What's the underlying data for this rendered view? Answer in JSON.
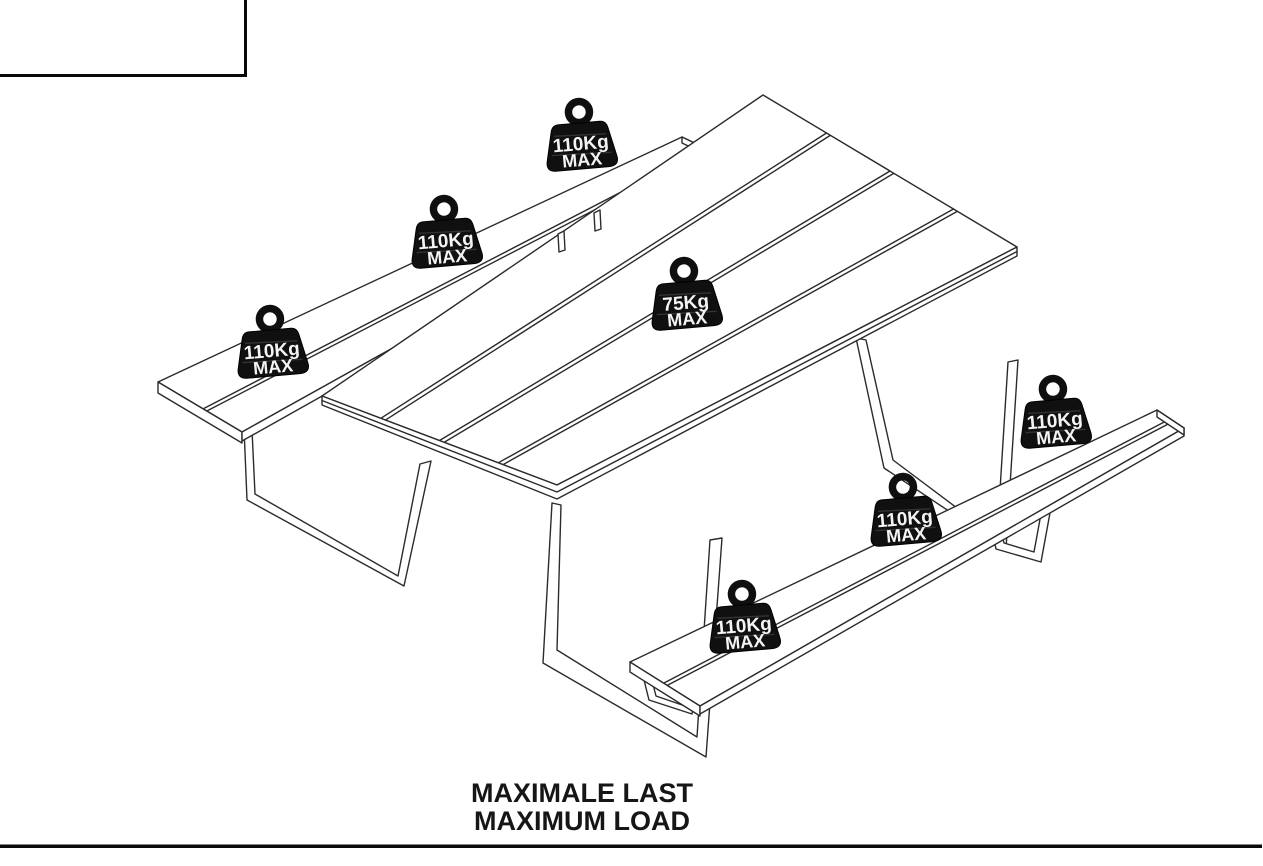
{
  "drawing": {
    "caption": {
      "line1": "MAXIMALE LAST",
      "line2": "MAXIMUM LOAD"
    },
    "weights": [
      {
        "label": "110Kg",
        "sub": "MAX"
      },
      {
        "label": "110Kg",
        "sub": "MAX"
      },
      {
        "label": "110Kg",
        "sub": "MAX"
      },
      {
        "label": "75Kg",
        "sub": "MAX"
      },
      {
        "label": "110Kg",
        "sub": "MAX"
      },
      {
        "label": "110Kg",
        "sub": "MAX"
      },
      {
        "label": "110Kg",
        "sub": "MAX"
      }
    ],
    "colors": {
      "background": "#ffffff",
      "line": "#2b2b2b",
      "frame": "#0a0a0a",
      "weight_body": "#101010",
      "weight_text": "#f4f4f4",
      "caption_text": "#161616"
    }
  }
}
